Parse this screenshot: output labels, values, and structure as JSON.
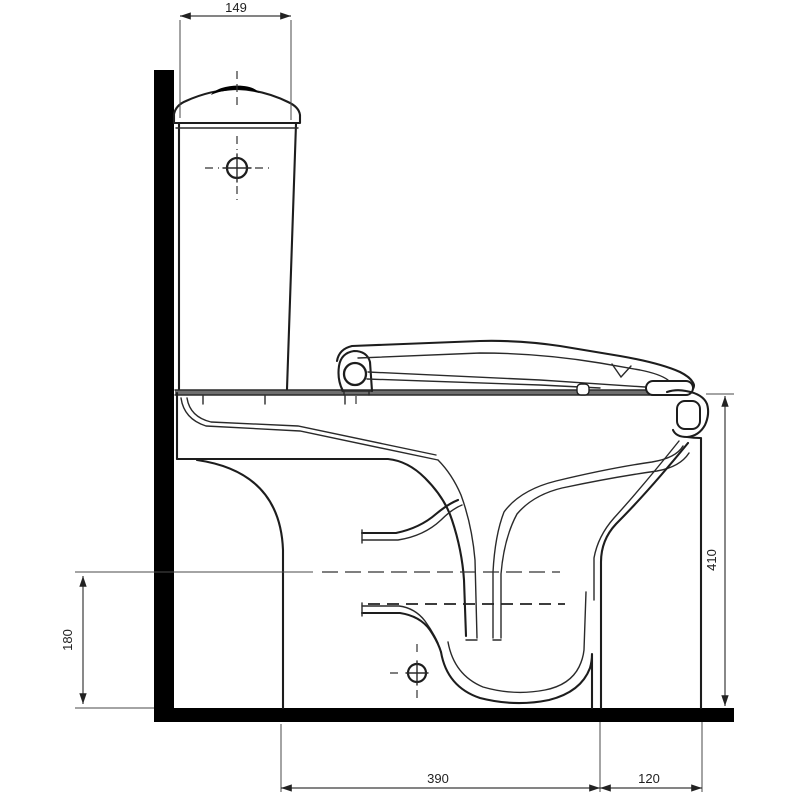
{
  "drawing": {
    "title": "toilet side elevation technical drawing",
    "dimensions": {
      "tank_top_width": "149",
      "rim_height_right": "410",
      "outlet_axis_height_left": "180",
      "base_depth_main": "390",
      "base_depth_front": "120"
    },
    "colors": {
      "line": "#1d1d1d",
      "background": "#ffffff",
      "datum_fill": "#000000",
      "deck_gray": "#6f6f6f"
    }
  }
}
